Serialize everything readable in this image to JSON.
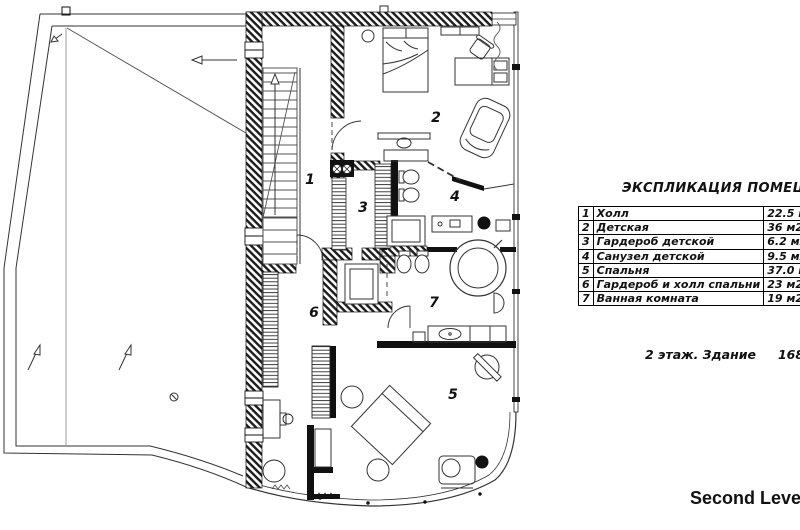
{
  "legend": {
    "title": "ЭКСПЛИКАЦИЯ ПОМЕЩЕНИЙ",
    "rows": [
      {
        "num": "1",
        "name": "Холл",
        "area": "22.5 м2"
      },
      {
        "num": "2",
        "name": "Детская",
        "area": "36 м2"
      },
      {
        "num": "3",
        "name": "Гардероб детской",
        "area": "6.2 м2"
      },
      {
        "num": "4",
        "name": "Санузел детской",
        "area": "9.5 м2"
      },
      {
        "num": "5",
        "name": "Спальня",
        "area": "37.0 м2"
      },
      {
        "num": "6",
        "name": "Гардероб и холл спальни",
        "area": "23 м2"
      },
      {
        "num": "7",
        "name": "Ванная комната",
        "area": "19 м2"
      }
    ],
    "summary": {
      "floor_text": "2 этаж. Здание",
      "area_text": "168 м2"
    },
    "level_label": "Second Level"
  },
  "colors": {
    "ink": "#1a1a1a",
    "wall": "#1c1c1c",
    "gray": "#9a9a9a"
  }
}
